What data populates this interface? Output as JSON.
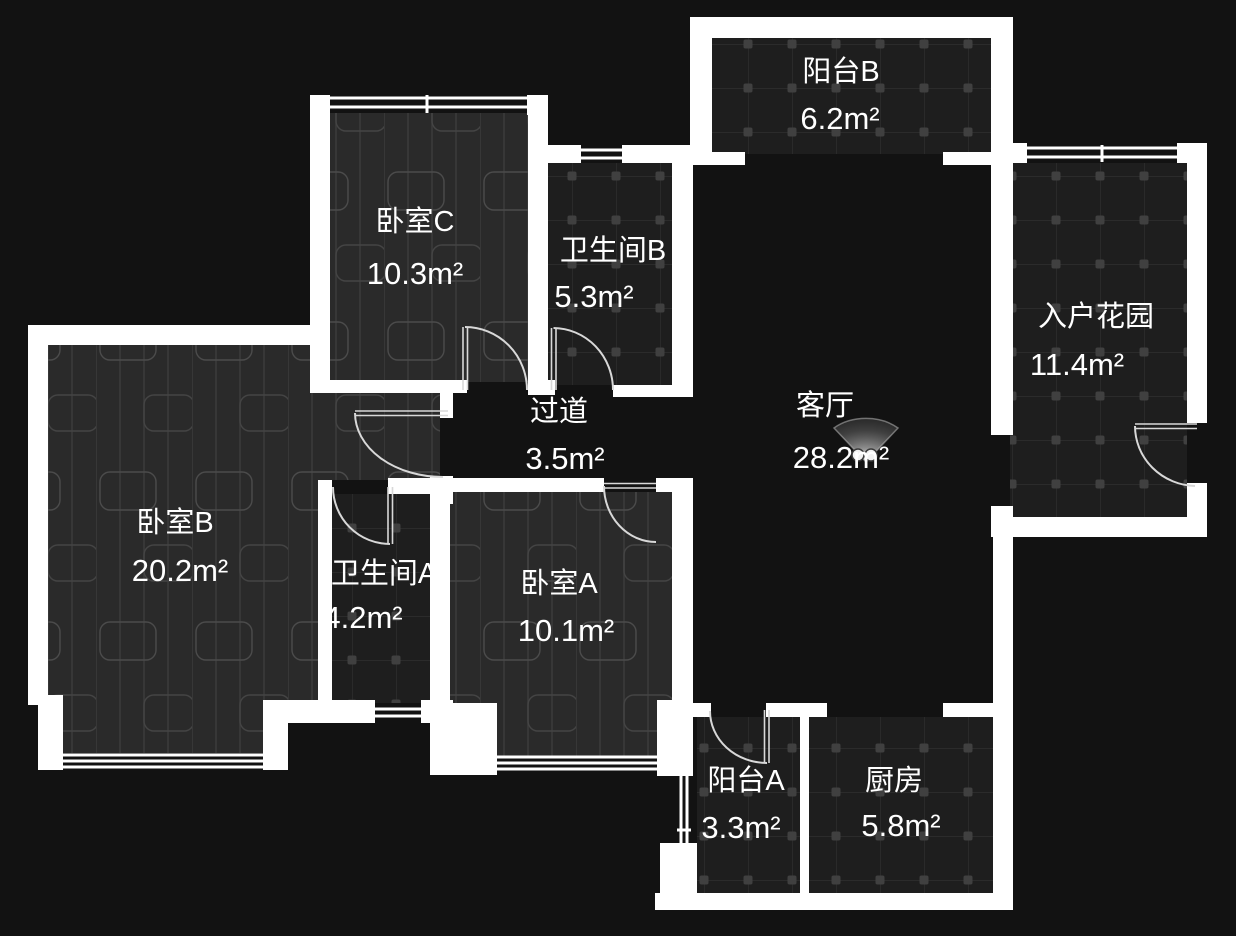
{
  "plan": {
    "type": "apartment-floor-plan",
    "theme": "dark",
    "unit": "m²"
  },
  "colors": {
    "background": "#121212",
    "wall": "#ffffff",
    "wood_floor": "#2a2a2a",
    "wood_line": "#3b3b3b",
    "wood_grain": "#4b4b4b",
    "tile_floor": "#1e1e1e",
    "tile_line": "#2f2f2f",
    "tile_dot": "#404040",
    "door_arc": "#d8d8d8",
    "label_text": "#ffffff"
  },
  "rooms": [
    {
      "id": "balcony-b",
      "name": "阳台B",
      "area": "6.2m²"
    },
    {
      "id": "bedroom-c",
      "name": "卧室C",
      "area": "10.3m²"
    },
    {
      "id": "bathroom-b",
      "name": "卫生间B",
      "area": "5.3m²"
    },
    {
      "id": "entry-garden",
      "name": "入户花园",
      "area": "11.4m²"
    },
    {
      "id": "living-room",
      "name": "客厅",
      "area": "28.2m²"
    },
    {
      "id": "hallway",
      "name": "过道",
      "area": "3.5m²"
    },
    {
      "id": "bedroom-b",
      "name": "卧室B",
      "area": "20.2m²"
    },
    {
      "id": "bathroom-a",
      "name": "卫生间A",
      "area": "4.2m²"
    },
    {
      "id": "bedroom-a",
      "name": "卧室A",
      "area": "10.1m²"
    },
    {
      "id": "balcony-a",
      "name": "阳台A",
      "area": "3.3m²"
    },
    {
      "id": "kitchen",
      "name": "厨房",
      "area": "5.8m²"
    }
  ],
  "fixtures": [
    {
      "id": "light-fixture",
      "room": "客厅"
    }
  ]
}
